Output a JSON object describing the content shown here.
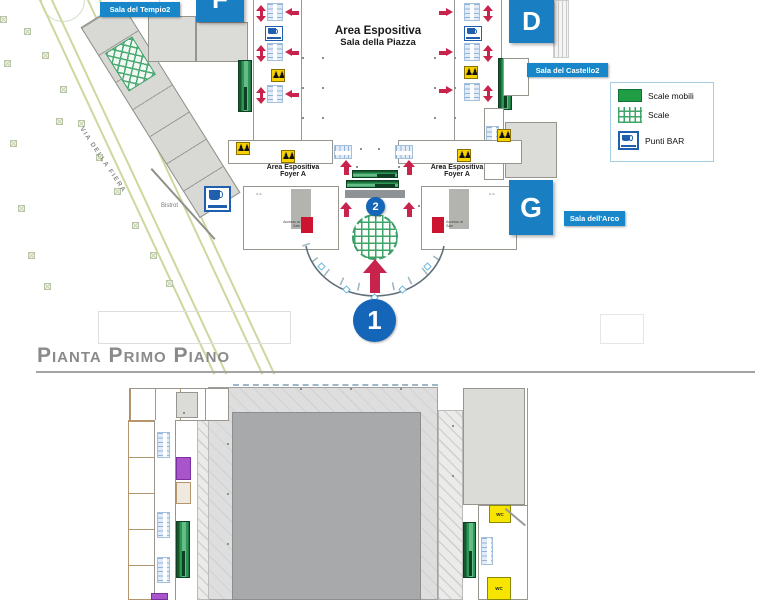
{
  "colors": {
    "accent_blue": "#1a7ec2",
    "marker_blue": "#1565b8",
    "arrow_red": "#c8234c",
    "escalator_green": "#2c9655",
    "stairs_green": "#3fa469",
    "wc_yellow": "#f7e400",
    "room_purple": "#a855cc"
  },
  "top_plan": {
    "street_label": "VIA DELLA FIERA",
    "bistrot_label": "Bistrot",
    "badges": {
      "tempio": "Sala del Tempio2",
      "castello": "Sala del Castello2",
      "arco": "Sala dell'Arco"
    },
    "halls": {
      "f": "F",
      "d": "D",
      "g": "G"
    },
    "piazza_title": {
      "line1": "Area Espositiva",
      "line2": "Sala della Piazza"
    },
    "foyer_left": {
      "line1": "Area Espositiva",
      "line2": "Foyer A"
    },
    "foyer_right": {
      "line1": "Area Espositiva",
      "line2": "Foyer A"
    },
    "markers": {
      "entrance": "1",
      "inner": "2"
    },
    "access_left": "Accesso ai Sale",
    "access_right": "Accesso ai Sale",
    "exit_left": "u.s.",
    "exit_right": "u.s."
  },
  "legend": {
    "items": [
      {
        "icon": "escalator-swatch",
        "label": "Scale mobili"
      },
      {
        "icon": "stairs-swatch",
        "label": "Scale"
      },
      {
        "icon": "bar-icon",
        "label": "Punti BAR"
      }
    ]
  },
  "section_heading": "Pianta Primo Piano",
  "bottom_plan": {
    "wc_top": "WC",
    "wc_bottom": "WC"
  }
}
